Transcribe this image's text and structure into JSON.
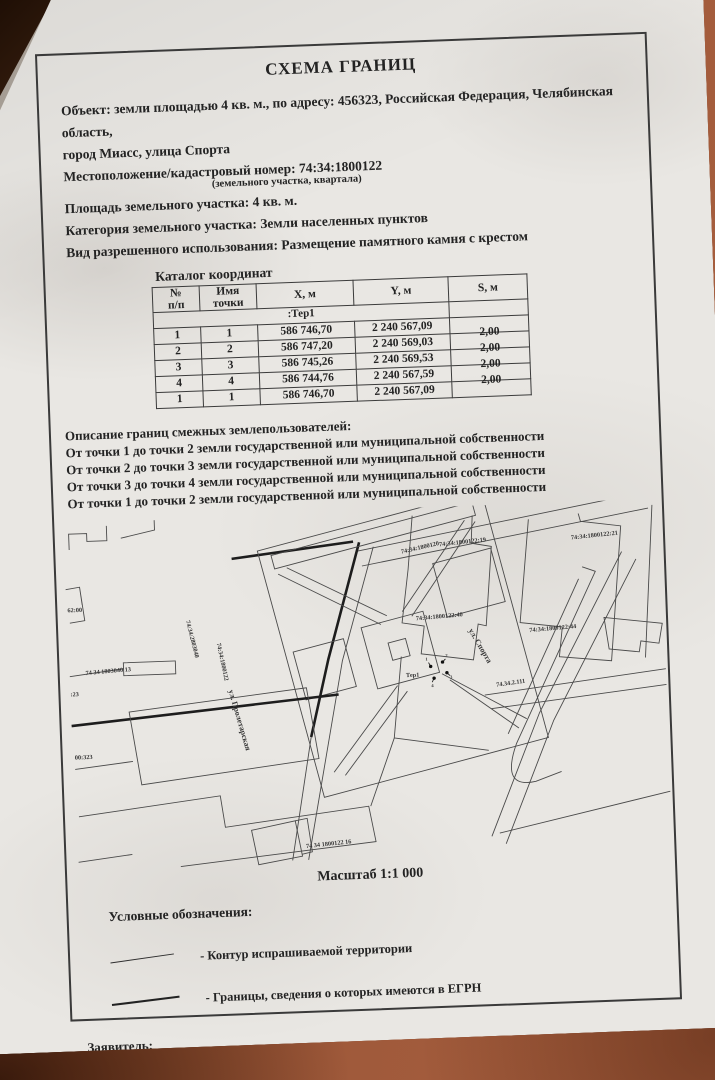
{
  "document": {
    "title": "СХЕМА ГРАНИЦ",
    "object_line1": "Объект: земли площадью 4 кв. м., по адресу: 456323, Российская Федерация, Челябинская область,",
    "object_line2": "город Миасс, улица Спорта",
    "location_line": "Местоположение/кадастровый номер: 74:34:1800122",
    "location_note": "(земельного участка, квартала)",
    "area_line": "Площадь земельного участка: 4 кв. м.",
    "category_line": "Категория земельного участка: Земли населенных пунктов",
    "usage_line": "Вид разрешенного использования: Размещение памятного камня с крестом"
  },
  "coords_table": {
    "title": "Каталог координат",
    "headers": [
      {
        "line1": "№",
        "line2": "п/п"
      },
      {
        "line1": "Имя",
        "line2": "точки"
      },
      {
        "line1": "X, м",
        "line2": ""
      },
      {
        "line1": "Y, м",
        "line2": ""
      },
      {
        "line1": "S, м",
        "line2": ""
      }
    ],
    "group_label": ":Тер1",
    "rows": [
      {
        "n": "1",
        "name": "1",
        "x": "586 746,70",
        "y": "2 240 567,09",
        "s": "2,00"
      },
      {
        "n": "2",
        "name": "2",
        "x": "586 747,20",
        "y": "2 240 569,03",
        "s": "2,00"
      },
      {
        "n": "3",
        "name": "3",
        "x": "586 745,26",
        "y": "2 240 569,53",
        "s": "2,00"
      },
      {
        "n": "4",
        "name": "4",
        "x": "586 744,76",
        "y": "2 240 567,59",
        "s": "2,00"
      },
      {
        "n": "1",
        "name": "1",
        "x": "586 746,70",
        "y": "2 240 567,09",
        "s": ""
      }
    ]
  },
  "boundaries": {
    "title": "Описание границ смежных землепользователей:",
    "lines": [
      "От точки 1 до точки 2 земли государственной или муниципальной собственности",
      "От точки 2 до точки 3 земли государственной или муниципальной собственности",
      "От точки 3 до точки 4 земли государственной или муниципальной собственности",
      "От точки 1 до точки 2 земли государственной или муниципальной собственности"
    ]
  },
  "map": {
    "scale_label": "Масштаб 1:1 000",
    "territory_label": "Тер1",
    "point_numbers": [
      "1",
      "2",
      "3",
      "4"
    ],
    "labels": {
      "street_top_quarter": "74:34:1800120",
      "parcel_19": "74:34:1800122:19",
      "parcel_21": "74:34:1800122:21",
      "parcel_44": "74:34:1800122:44",
      "parcel_40": "74:34:1800122:40",
      "street_sporta": "ул. Спорта",
      "road_2_111": "74.34.2.111",
      "street_proletarskaya": "ул. Пролетарская",
      "quarter_2803040": "74:34:2803040",
      "quarter_1800122": "74:34:1800122",
      "parcel_62": "62:00",
      "parcel_1803040_13": "74 34 1803040 13",
      "parcel_23": ":23",
      "parcel_00323": "00:323",
      "parcel_16": "74 34 1800122 16"
    }
  },
  "legend": {
    "title": "Условные обозначения:",
    "items": [
      {
        "label": "- Контур испрашиваемой территории"
      },
      {
        "label": "- Границы, сведения о которых имеются в ЕГРН"
      }
    ]
  },
  "footer": {
    "applicant_label": "Заявитель:",
    "signature_note": "(подпись, расшифровка подписи)"
  }
}
